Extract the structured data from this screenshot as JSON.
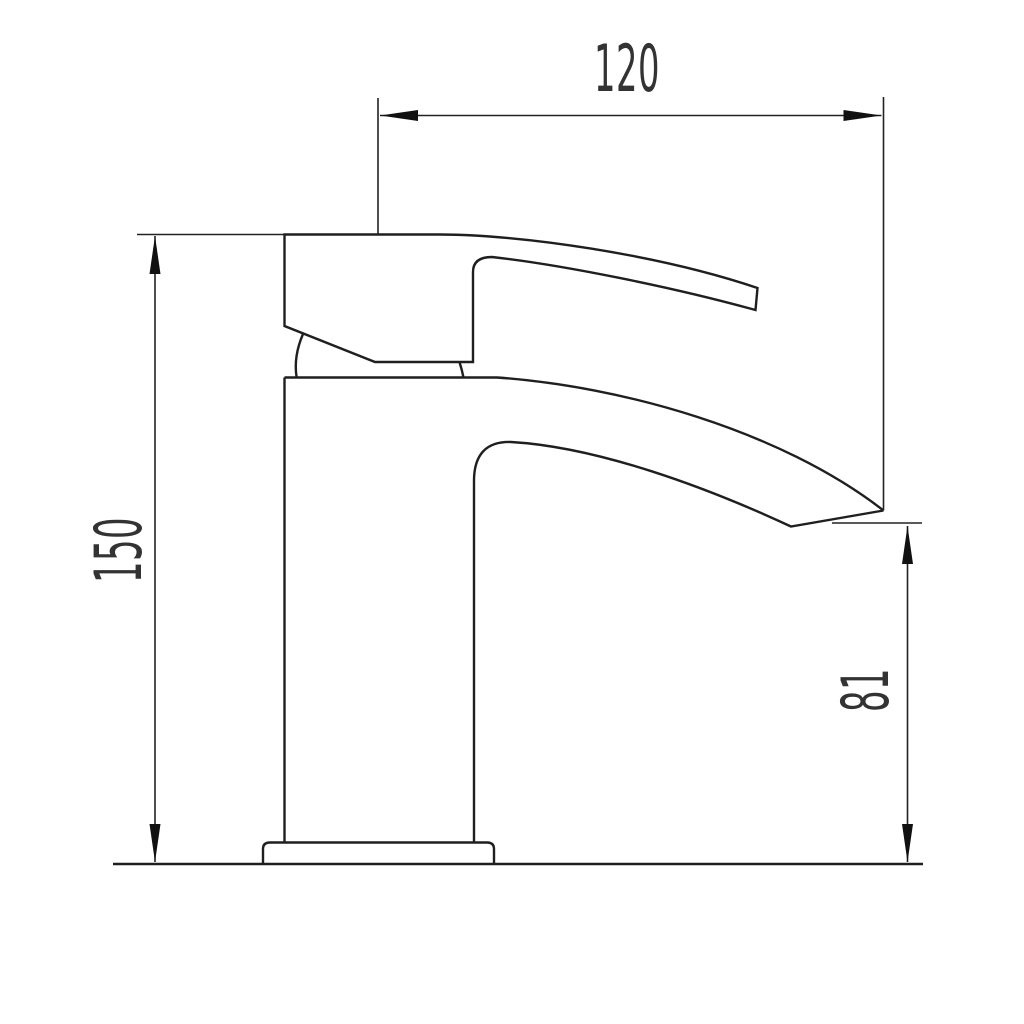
{
  "drawing": {
    "subject": "single-lever waterfall basin mixer tap, side elevation",
    "colors": {
      "background": "#ffffff",
      "line": "#1f1f1f",
      "text": "#333333"
    },
    "dimensions": [
      {
        "name": "width",
        "label": "120",
        "orientation": "horizontal"
      },
      {
        "name": "overall-height",
        "label": "150",
        "orientation": "vertical"
      },
      {
        "name": "spout-height",
        "label": "81",
        "orientation": "vertical"
      }
    ]
  }
}
